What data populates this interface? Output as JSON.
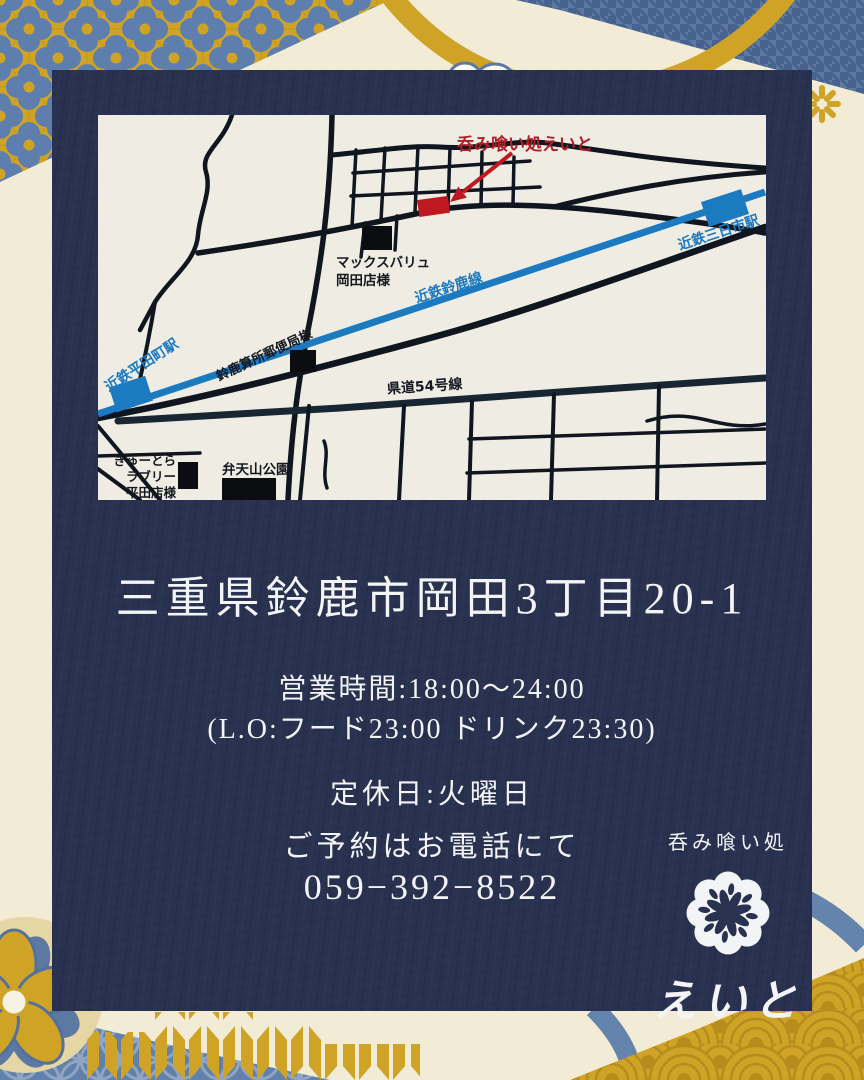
{
  "colors": {
    "card_navy": "#293250",
    "background_cream": "#f2ecd7",
    "accent_gold": "#cfa326",
    "pattern_blue": "#5c79a2",
    "map_background": "#efece3",
    "railway_blue": "#1b79c0",
    "road_black": "#10161f",
    "restaurant_red": "#b01f27",
    "text_white": "#f3f4f6"
  },
  "map": {
    "title": "呑み喰い処えいと",
    "labels": {
      "maxvalu_line1": "マックスバリュ",
      "maxvalu_line2": "岡田店様",
      "mikkaichi_station": "近鉄三日市駅",
      "suzuka_line": "近鉄鈴鹿線",
      "hiratacho_station": "近鉄平田町駅",
      "post_office": "鈴鹿算所郵便局様",
      "route54": "県道54号線",
      "gyutora_line1": "ぎゅーとら",
      "gyutora_line2": "ラブリー",
      "gyutora_line3": "平田店様",
      "park": "弁天山公園"
    }
  },
  "info": {
    "address": "三重県鈴鹿市岡田3丁目20-1",
    "hours_line1": "営業時間:18:00〜24:00",
    "hours_line2": "(L.O:フード23:00  ドリンク23:30)",
    "closed": "定休日:火曜日",
    "reservation": "ご予約はお電話にて",
    "phone": "059−392−8522"
  },
  "logo": {
    "tagline": "呑み喰い処",
    "name": "えいと"
  }
}
